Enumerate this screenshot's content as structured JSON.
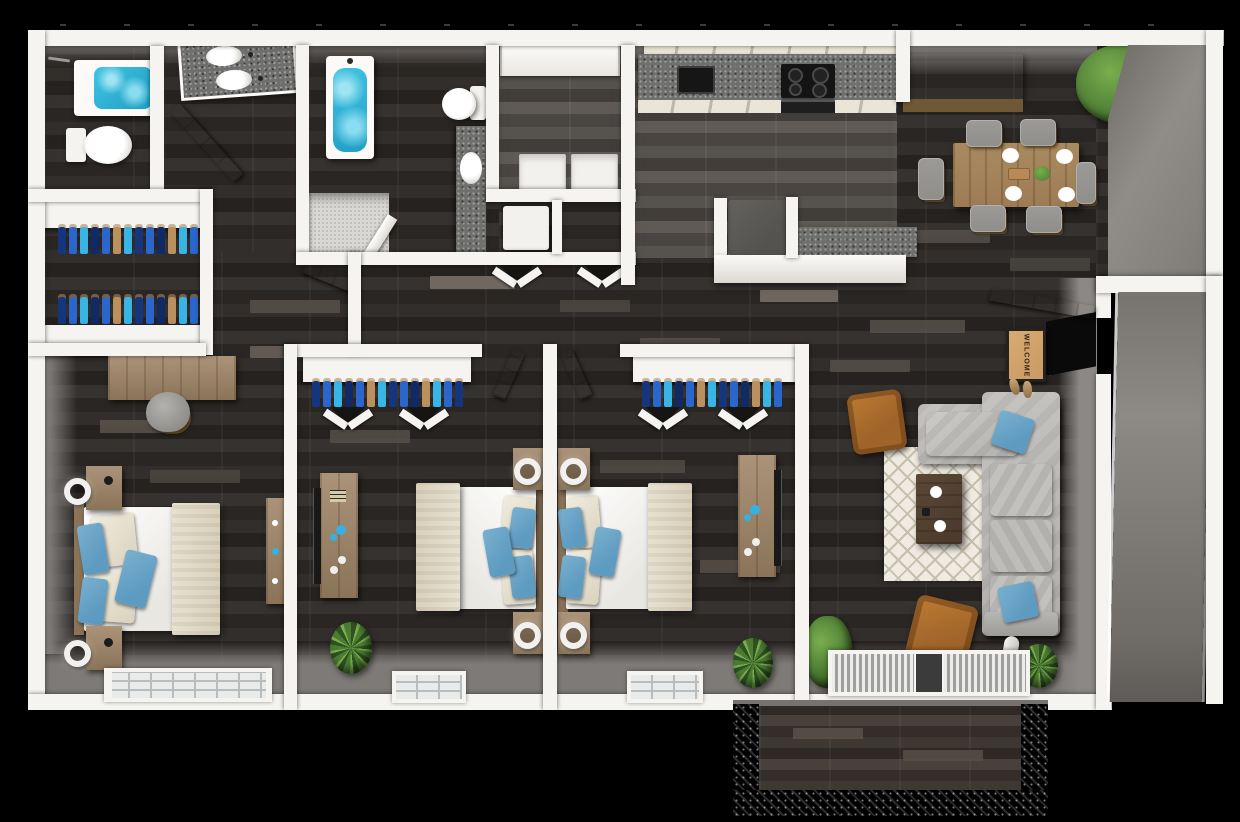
{
  "welcome_mat": {
    "text": "WELCOME"
  },
  "shirts": {
    "colors": [
      "#15357e",
      "#2a66cc",
      "#38b5e6",
      "#0f2a66",
      "#2a66cc",
      "#b9905e",
      "#38b5e6",
      "#15357e",
      "#2a66cc",
      "#0f2a66",
      "#b9905e",
      "#38b5e6",
      "#2a66cc",
      "#15357e"
    ]
  },
  "colors": {
    "bg": "#000000",
    "wall": "#f5f4f1",
    "wall_face": "#8b8885",
    "wall_face_dark": "#6e6b67",
    "gray_floor": "#7d7a77",
    "floor": "#2d2a27",
    "plank_light": "#7a7268",
    "plank_mid": "#57504a",
    "kitchen_plank": "#8a837b",
    "tile": "#d9d8d4",
    "water": "#41c3e3",
    "water_deep": "#1f9fc4",
    "granite": "#6f6f6d",
    "cream": "#eae5d6",
    "cream_line": "#bcb7a9",
    "black_appliance": "#161616",
    "fridge": "#55534f",
    "wood": "#ab9379",
    "wood_dark": "#8a7458",
    "dining_wood": "#9d7c55",
    "chair_gray": "#8f8e8b",
    "sofa": "#b0aeab",
    "sofa_cushion": "#c6c4c1",
    "pillow_blue": "#5e9bc1",
    "blanket": "#e8e1cf",
    "rug": "#efebe1",
    "rug_line": "#c6bfae",
    "coffee": "#4a392b",
    "brown_chair": "#a0642a",
    "brown_chair_dark": "#74451a",
    "plant": "#4c7c33",
    "plant_light": "#79ae4f",
    "plant_dark": "#2e5220",
    "mat": "#c99a62",
    "mat_text": "#2e2417",
    "lamp_white": "#f2f1ef",
    "window_pane": "#e9ebeb",
    "white_goods": "#f2f1ee",
    "deck": "#352f2b"
  }
}
